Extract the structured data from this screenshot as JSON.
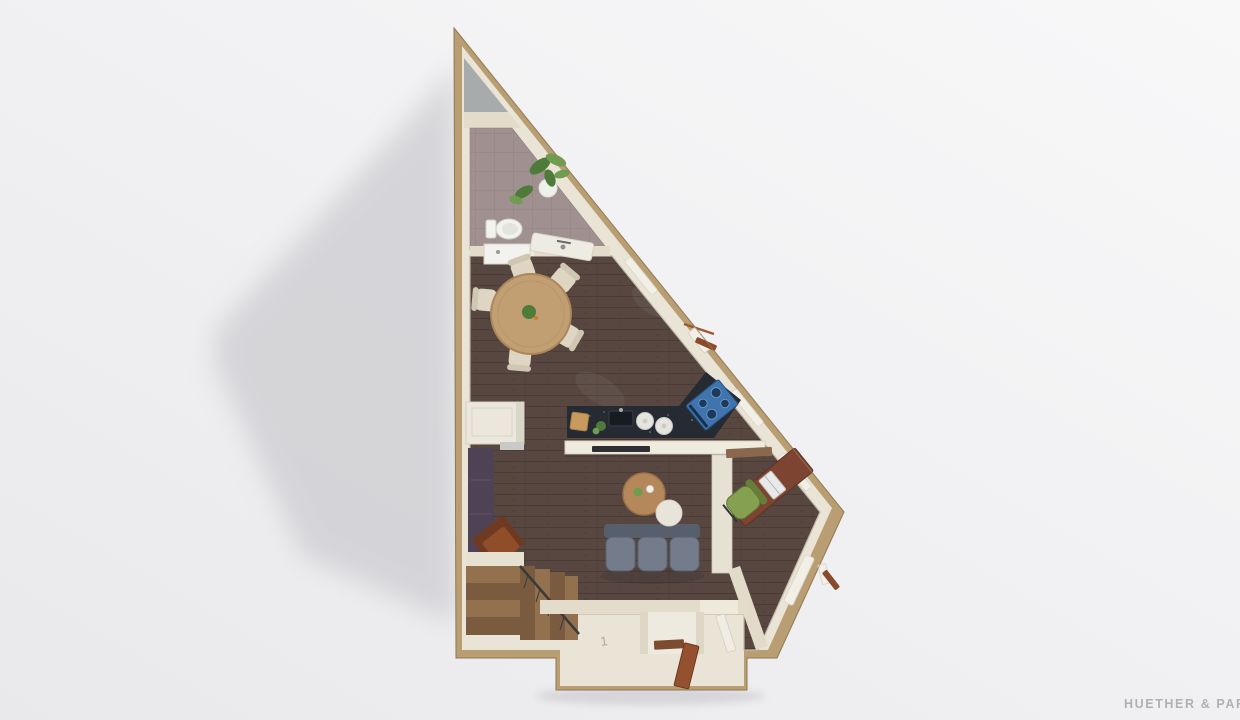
{
  "watermark": {
    "text": "HUETHER & PARTNE",
    "color": "#a6a6a9"
  },
  "entrance": {
    "number_label": "1"
  },
  "scene": {
    "background_top": "#f8f8f9",
    "background_bottom": "#e9e9ec",
    "shadow": "#cfcfd3"
  },
  "palette": {
    "wall_outer": "#b89e72",
    "wall_outer_edge": "#8f7750",
    "wall_inner": "#eae4d6",
    "wall_inner_shade": "#ddd5c2",
    "floor_wood": "#584741",
    "plank_line": "#453530",
    "bathroom_tile": "#a09190",
    "tile_grout": "#8b7c7b",
    "apex_gray": "#a7abac",
    "counter_top": "#262a33",
    "cooktop_blue": "#3f74ae",
    "burner_dark": "#1d3a5c",
    "bar_white": "#efebdf",
    "sofa": "#747c8b",
    "sofa_dark": "#575e6c",
    "armchair": "#8f4d2a",
    "armchair_dark": "#6f3a1f",
    "dining_table": "#c29e73",
    "coffee_table": "#b4885a",
    "side_table": "#e8e4da",
    "chair_cream": "#ded6c3",
    "office_chair": "#85a050",
    "office_chair_dark": "#657f3b",
    "desk_wood": "#7c4431",
    "laptop": "#e9e9e9",
    "stairs_light": "#93714f",
    "stairs_dark": "#7b5b40",
    "railing": "#3a3a3a",
    "door_brown": "#93512f",
    "sideboard": "#4e4254",
    "cabinet_white": "#ece7dc",
    "plant_green": "#4e7a3a",
    "plant_green_light": "#6f9c4e",
    "pot_white": "#efefec",
    "porcelain": "#f2f2ef",
    "mat_brown": "#7d4b2e",
    "window_frame": "#f2efe7",
    "shutter_brown": "#8a4a2c"
  },
  "items": [
    "bathroom",
    "dining-area",
    "kitchen",
    "living-area",
    "office-nook",
    "staircase",
    "entrance-porch",
    "toilet",
    "shower",
    "vanity",
    "dining-table",
    "kitchen-island",
    "cooktop",
    "breakfast-bar",
    "sofa",
    "coffee-table",
    "armchair",
    "desk",
    "laptop",
    "office-chair",
    "sideboard",
    "cabinet",
    "open-entrance-door",
    "windows",
    "plants"
  ]
}
